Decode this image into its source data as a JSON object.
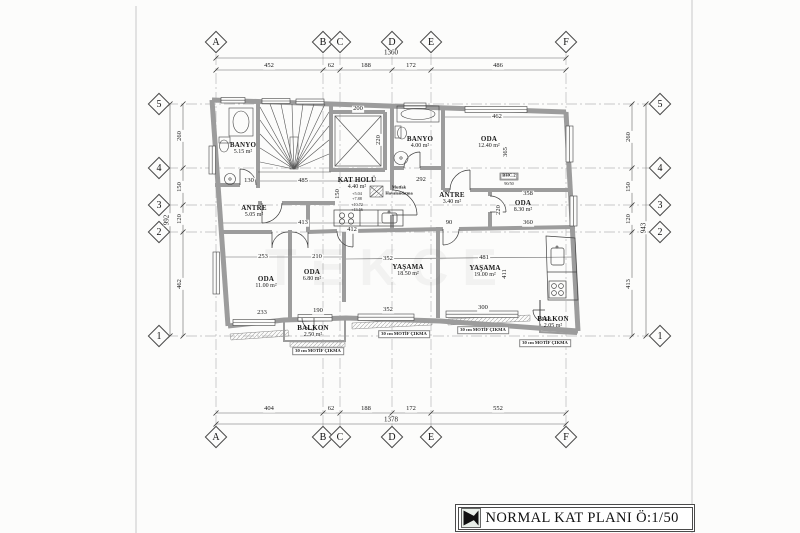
{
  "title": "NORMAL KAT PLANI Ö:1/50",
  "watermark": "TEKCE",
  "grid": {
    "cols": [
      "A",
      "B",
      "C",
      "D",
      "E",
      "F"
    ],
    "rows": [
      "5",
      "4",
      "3",
      "2",
      "1"
    ]
  },
  "dims": {
    "top_total": "1360",
    "top": [
      "452",
      "62",
      "188",
      "172",
      "486"
    ],
    "bottom_total": "1378",
    "bottom": [
      "404",
      "62",
      "188",
      "172",
      "552"
    ],
    "left_total": "992",
    "left": [
      "260",
      "150",
      "120",
      "462"
    ],
    "right_total": "943",
    "right": [
      "260",
      "150",
      "120",
      "413"
    ]
  },
  "rooms": {
    "banyo1": {
      "label": "BANYO",
      "area": "5.15 m²"
    },
    "banyo2": {
      "label": "BANYO",
      "area": "4.00 m²"
    },
    "oda1240": {
      "label": "ODA",
      "area": "12.40 m²"
    },
    "kathol": {
      "label": "KAT HOLÜ",
      "area": "4.40 m²"
    },
    "antre1": {
      "label": "ANTRE",
      "area": "5.05 m²"
    },
    "antre2": {
      "label": "ANTRE",
      "area": "3.40 m²"
    },
    "oda830": {
      "label": "ODA",
      "area": "8.30 m²"
    },
    "oda1100": {
      "label": "ODA",
      "area": "11.00 m²"
    },
    "oda680": {
      "label": "ODA",
      "area": "6.80 m²"
    },
    "yasama1": {
      "label": "YAŞAMA",
      "area": "18.50 m²"
    },
    "yasama2": {
      "label": "YAŞAMA",
      "area": "19.00 m²"
    },
    "balkon1": {
      "label": "BALKON",
      "area": "2.50 m²"
    },
    "balkon2": {
      "label": "BALKON",
      "area": "2.05 m²"
    }
  },
  "inner": {
    "elev_w": "200",
    "elev_d": "220",
    "hall_w": "485",
    "hall_left": "130",
    "hall_h": "150",
    "antre1_w": "413",
    "oda1100_w": "253",
    "oda680_w": "210",
    "oda1100_win": "233",
    "balkon1_w": "190",
    "yasama1_w": "352",
    "yasama2_w": "481",
    "yasama2_h": "411",
    "yasama1_win": "352",
    "yasama2_win": "300",
    "balkon2_w": "168",
    "oda1240_w": "462",
    "oda1240_h": "365",
    "antre2_w": "292",
    "antre2_d": "90",
    "oda830_w1": "358",
    "oda830_w2": "360",
    "oda830_h": "220",
    "counter_w": "412"
  },
  "annotations": {
    "vent1": "Mutfak",
    "vent2": "Havalandırma",
    "motif": "30 cm MOTİF ÇIKMA",
    "bhc": "BHC.2",
    "bhc_size": "90/50",
    "levels": [
      "+5.04",
      "+7.88",
      "+10.72",
      "+13.56"
    ]
  },
  "colors": {
    "wall": "#9c9c9c",
    "line": "#3a3a3a",
    "grid": "#b8b8b8",
    "dim": "#666666"
  }
}
